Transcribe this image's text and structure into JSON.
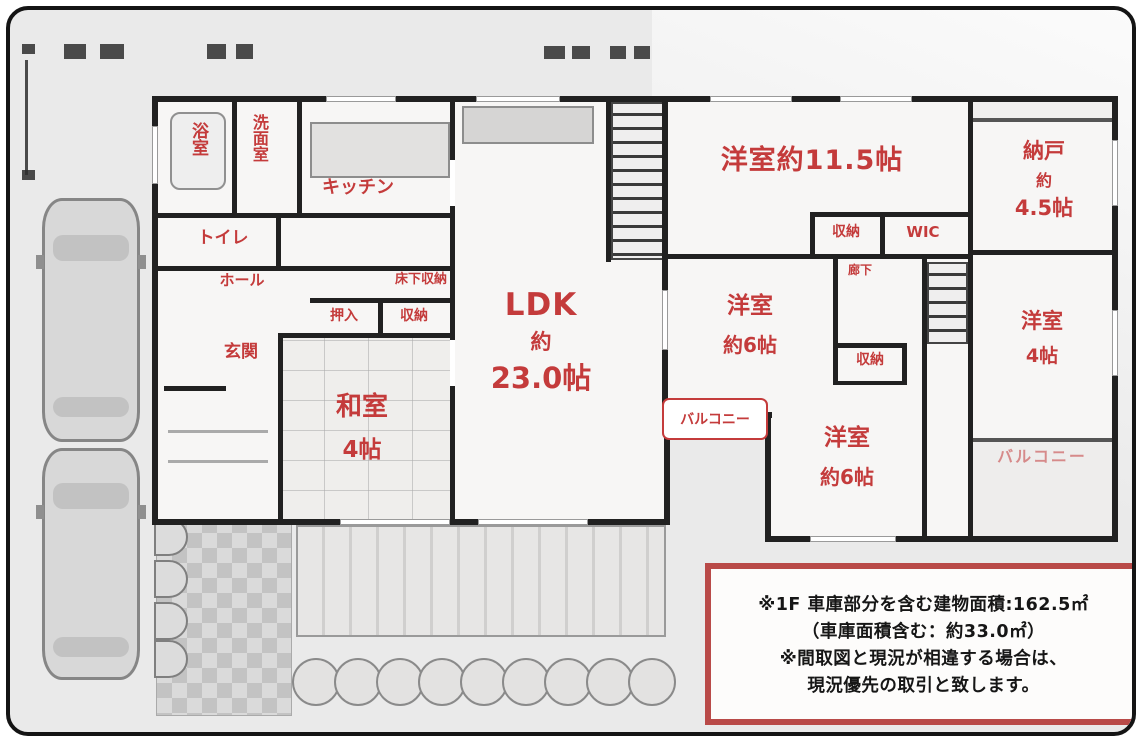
{
  "colors": {
    "label_red": "#c43b3b",
    "wall": "#212121",
    "note_border": "#b94a48",
    "background": "#eaeaea"
  },
  "floor1": {
    "bath": "浴室",
    "washroom": "洗面室",
    "toilet": "トイレ",
    "kitchen": "キッチン",
    "hall": "ホール",
    "entrance": "玄関",
    "under_floor_storage": "床下収納",
    "oshiire": "押入",
    "storage": "収納",
    "washitsu": [
      "和室",
      "4帖"
    ],
    "ldk": [
      "LDK",
      "約",
      "23.0帖"
    ]
  },
  "floor2": {
    "master": "洋室約11.5帖",
    "nando": [
      "納戸",
      "約",
      "4.5帖"
    ],
    "closet": "収納",
    "wic": "WIC",
    "hallway": "廊下",
    "west1": [
      "洋室",
      "約6帖"
    ],
    "west2": [
      "洋室",
      "4帖"
    ],
    "west3": [
      "洋室",
      "約6帖"
    ],
    "closet2": "収納",
    "balcony_tag": "バルコニー",
    "balcony2": "バルコニー"
  },
  "note_box": {
    "lines": [
      "※1F 車庫部分を含む建物面積:162.5㎡",
      "（車庫面積含む：約33.0㎡）",
      "※間取図と現況が相違する場合は、",
      "現況優先の取引と致します。"
    ]
  }
}
